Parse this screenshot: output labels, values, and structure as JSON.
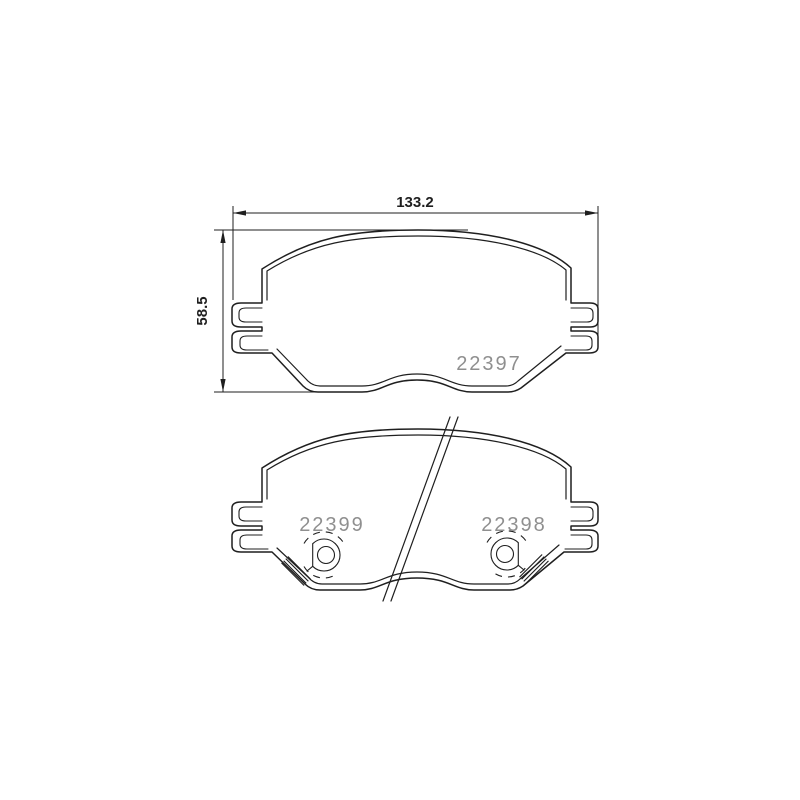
{
  "figure": {
    "type": "technical-drawing",
    "background_color": "#ffffff",
    "line_color": "#1f1f1f",
    "part_number_color": "#8f8f8f",
    "dimensions": {
      "width_label": "133.2",
      "height_label": "58.5"
    },
    "part_numbers": {
      "top_view": "22397",
      "bottom_view_left": "22399",
      "bottom_view_right": "22398"
    }
  }
}
